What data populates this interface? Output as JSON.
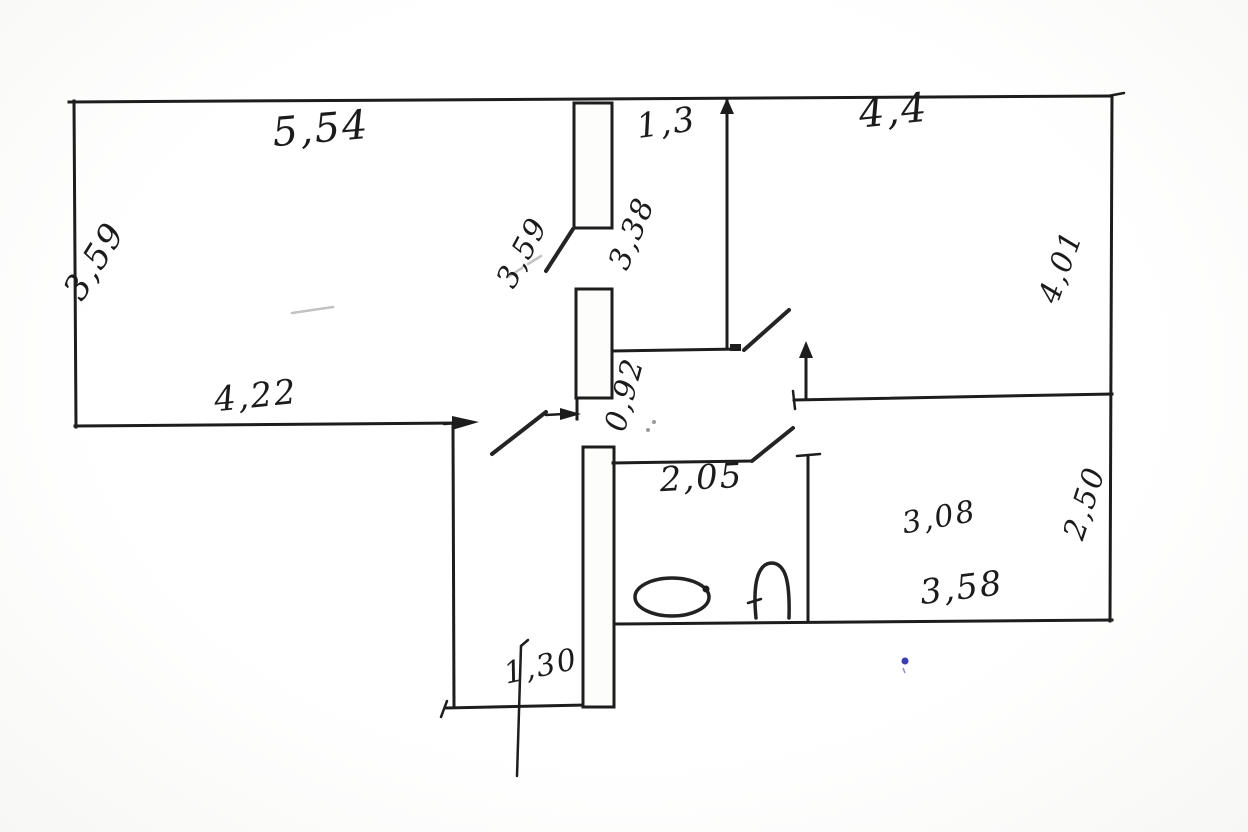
{
  "floor_plan": {
    "ink_color": "#1d1d1d",
    "accent_mark_color": "#3c3cae",
    "dimension_labels": [
      {
        "id": "top-left-room-width",
        "text": "5,54"
      },
      {
        "id": "top-left-room-depth",
        "text": "3,59"
      },
      {
        "id": "hall-width",
        "text": "1,3"
      },
      {
        "id": "hall-door-left",
        "text": "3,59"
      },
      {
        "id": "hall-door-right",
        "text": "3,38"
      },
      {
        "id": "top-right-room-width",
        "text": "4,4"
      },
      {
        "id": "top-right-room-depth",
        "text": "4,01"
      },
      {
        "id": "living-room-bottom-width",
        "text": "4,22"
      },
      {
        "id": "center-door-width",
        "text": "0,92"
      },
      {
        "id": "bathroom-width",
        "text": "2,05"
      },
      {
        "id": "bottom-right-room-width",
        "text": "3,08"
      },
      {
        "id": "bottom-right-room-bottom-width",
        "text": "3,58"
      },
      {
        "id": "bottom-right-room-depth",
        "text": "2,50"
      },
      {
        "id": "extension-width",
        "text": "1,30"
      }
    ]
  }
}
